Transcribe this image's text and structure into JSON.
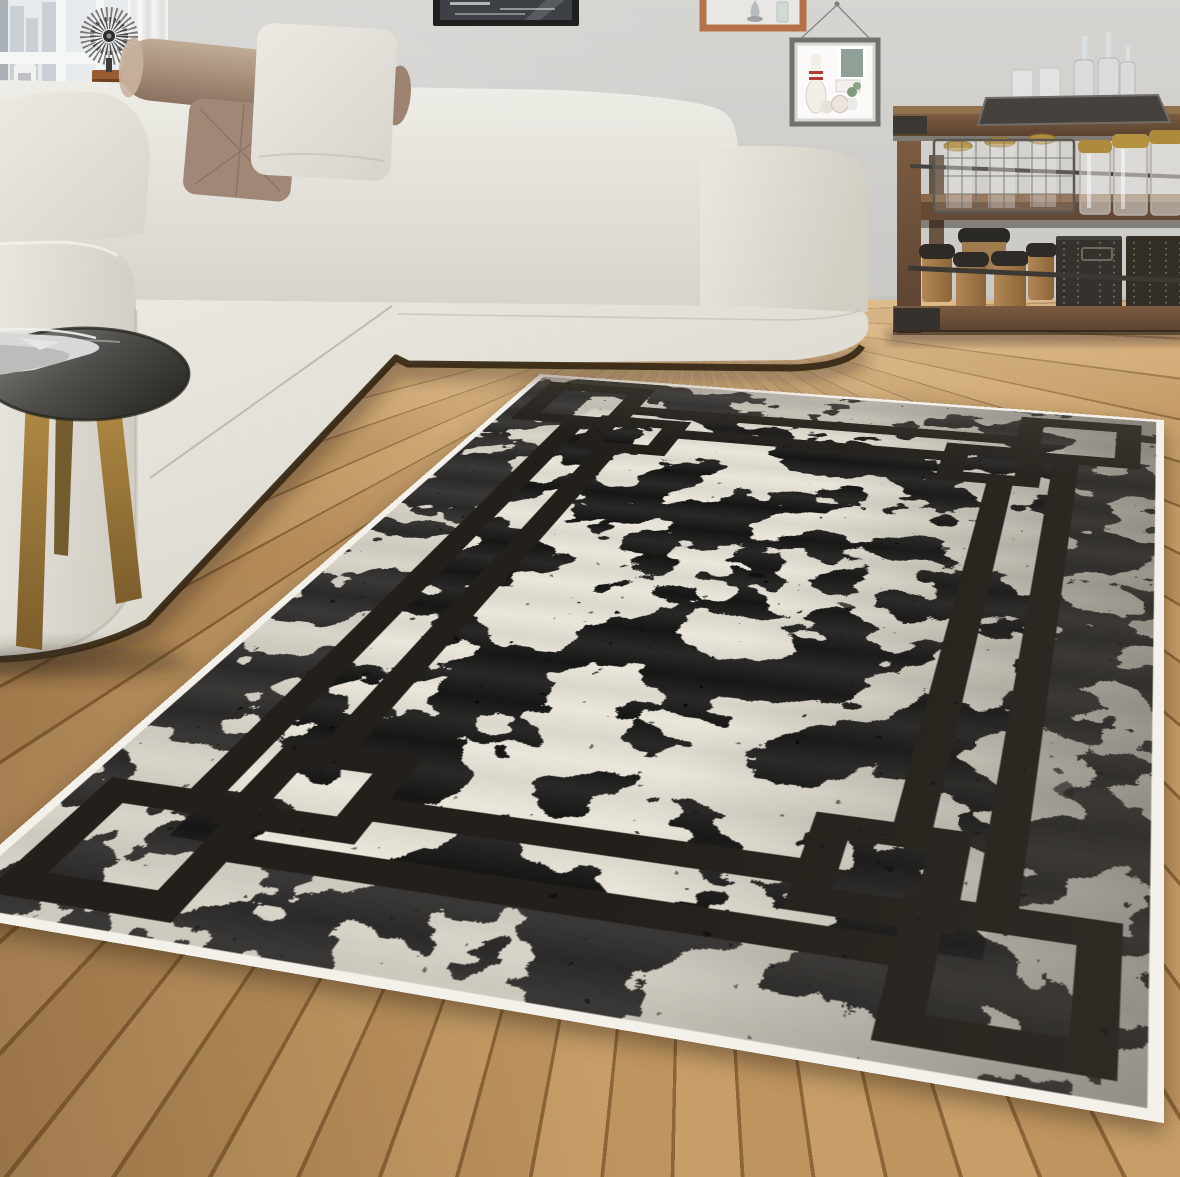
{
  "meta": {
    "type": "natural-image",
    "subject": "Product photo of a cream and grey distressed area rug with black interlocking-square border, staged in a modern living room",
    "canvas": {
      "width": 1180,
      "height": 1177
    }
  },
  "palette": {
    "wall": "#d6d5d2",
    "floor_light": "#c89e68",
    "floor_mid": "#bf945f",
    "floor_seam": "#8c6538",
    "rug_field": "#eae6db",
    "rug_mottle": "#a29e94",
    "rug_speckle": "#4d4942",
    "rug_design": "#23201b",
    "rug_selvage": "#f4f0ea",
    "sofa_fabric": "#e8e5dd",
    "sofa_shadow": "#ccc8bd",
    "bolster_brown": "#a78e7a",
    "plinth_dark": "#3a2a16",
    "side_table_top": "#504e4a",
    "side_table_legs": "#a8833f",
    "console_wood": "#6a4e38",
    "console_dark": "#35322d",
    "canister_wood": "#a5804f",
    "jar_lid_gold": "#ad8a3e",
    "frame_black": "#1f1f1f",
    "cube_shelf_wood": "#b5714a",
    "curtain_white": "#ebebe8"
  },
  "rug": {
    "style": "double-line rectangular frame with interlocking square corner motifs",
    "texture": "distressed mottled cream, grey clouds, dark speckles",
    "border_lines_per_side": 2,
    "corner_motif": {
      "outer_ring_hole": "large square",
      "inner_knot_hole": "small square"
    },
    "shadow_side": "right edge darker"
  },
  "objects": {
    "sofa": {
      "kind": "L-shaped sectional",
      "fabric": "cream",
      "pillows": [
        "light grey square",
        "taupe bolster",
        "brown quilted",
        "light square"
      ]
    },
    "side_table": {
      "kind": "round tripod side table",
      "top": "dark metallic grey",
      "legs": "golden wood",
      "on_top": "folded silver-grey cloth on plate"
    },
    "console": {
      "kind": "rustic wood and metal console shelf",
      "items": [
        "metal tray with glasses and bottles",
        "wire basket with jars",
        "gold-lid mason jars",
        "wooden canisters with black lids",
        "dark studded crates"
      ]
    },
    "wall_art": {
      "kind": "black framed monochrome city photo, cropped by top edge"
    },
    "cube_shelf": {
      "kind": "terracotta wood cube shelf",
      "items": [
        "silver teardrop vase",
        "glass bottle"
      ]
    },
    "shadow_box": {
      "kind": "hanging shadow box on cord",
      "items": [
        "white bowling pin with red stripes",
        "two balls",
        "green card",
        "small plant"
      ]
    },
    "window": {
      "kind": "white window with sheer curtain",
      "sill_items": [
        "white mug",
        "spiky wire starburst sculpture on wood base"
      ]
    }
  }
}
